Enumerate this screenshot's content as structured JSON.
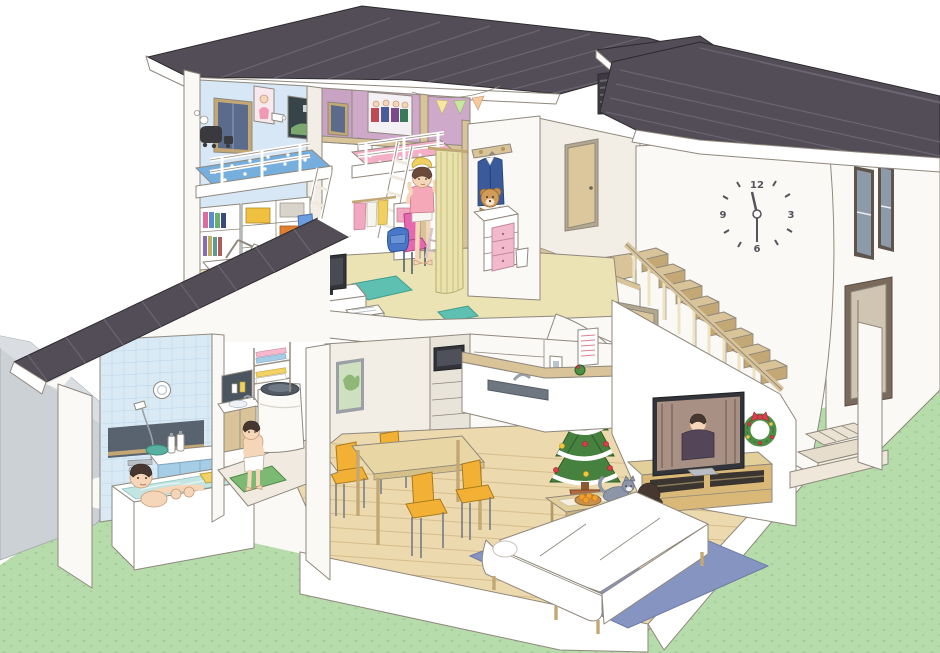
{
  "meta": {
    "title": "Cutaway cross-section illustration of a two-story family house",
    "description": "Isometric dollhouse-style cutaway showing a children's bedroom with two loft beds upstairs, a staircase with wall clock, and downstairs a bathroom with father bathing, a changing room with boy drying off, kitchen, dining set, and living room where a mother sits with two cats by a Christmas tree and TV.",
    "style": "isometric architectural cutaway illustration",
    "season": "Christmas"
  },
  "palette": {
    "roof": "#524d56",
    "roofSeam": "#6a6570",
    "line": "#8f887d",
    "line2": "#2e2b30",
    "wallWhite": "#faf9f6",
    "wallCream": "#f2eee6",
    "wood": "#d9c49a",
    "woodDark": "#c3a775",
    "woodFloor": "#ecd9ae",
    "plank": "#d6bd8c",
    "carpet": "#ece3b4",
    "tileBlue": "#d9eaf5",
    "tileLine": "#bcd7ea",
    "water": "#c2e4e2",
    "lawn": "#b7dcab",
    "lawnDot": "#a3cc95",
    "groundGray": "#ccd1d6",
    "rugBlue": "#8694c2",
    "rugTeal": "#5ec0b0",
    "bedBlue": "#76aede",
    "bedPink": "#f4aec6",
    "chairYellow": "#f2b135",
    "chairPink": "#e668b0",
    "chairBlue": "#6a9ce0",
    "skin": "#f6d6b8",
    "hairDark": "#463831",
    "hairBrown": "#6b4a3c",
    "tvDark": "#33343a",
    "doorTan": "#dcc79c",
    "curtain": "#e9e3ab",
    "treeGreen": "#47813f",
    "xmasRed": "#d6404e",
    "wallBlue": "#d7e7f5",
    "wallMauve": "#c9a3c4"
  },
  "clock": {
    "numerals": {
      "twelve": "12",
      "three": "3",
      "six": "6",
      "nine": "9"
    },
    "time_shown": "12:30"
  },
  "scene": {
    "floors": [
      "second floor: kids bedroom, closet, landing",
      "first floor: bathroom, changing room, kitchen, dining, living room, entry"
    ],
    "rooms": [
      {
        "name": "kids-bedroom",
        "objects": [
          "blue star loft bed",
          "pink heart loft bed",
          "two white ladders",
          "bookshelf",
          "storage cubbies with colored boxes",
          "study desk with lamp",
          "blue chair",
          "pink chair",
          "computer monitor",
          "black backpack",
          "blue schoolbag",
          "idol posters",
          "toy train wall decal",
          "dark window",
          "wall lamps",
          "pennant banner",
          "beige curtain",
          "school uniform on hanger",
          "teddy bear",
          "white dresser",
          "pink drawer chest",
          "teal rug"
        ]
      },
      {
        "name": "stair-hall",
        "objects": [
          "wall clock",
          "wooden staircase with railing",
          "tan doors",
          "wall niche",
          "louver vent"
        ]
      },
      {
        "name": "bathroom",
        "objects": [
          "bathtub with water",
          "shower head",
          "mixer faucet",
          "shampoo bottles",
          "green wash basin",
          "round vent fan",
          "blue tile wall",
          "yellow towel"
        ]
      },
      {
        "name": "changing-room",
        "objects": [
          "washing machine",
          "vanity sink",
          "towel shelf",
          "green bath mat",
          "white towel"
        ]
      },
      {
        "name": "kitchen",
        "objects": [
          "island counter with sink",
          "wood bar top",
          "built-in microwave",
          "cabinet drawers",
          "intercom panel",
          "wall calendar"
        ]
      },
      {
        "name": "dining",
        "objects": [
          "light wood dining table",
          "four yellow chairs",
          "green botanical picture"
        ]
      },
      {
        "name": "living-room",
        "objects": [
          "flat screen TV showing a person",
          "wooden TV stand",
          "Christmas wreath with red bow",
          "Christmas tree with star and garland",
          "coffee table",
          "basket of mandarin oranges",
          "blue rug",
          "white L-shaped sofa",
          "white cushion"
        ]
      },
      {
        "name": "entry",
        "objects": [
          "genkan tiled step",
          "porch post",
          "front door",
          "two tall windows"
        ]
      }
    ],
    "people": [
      {
        "name": "father",
        "activity": "relaxing in the bathtub",
        "location": "bathroom"
      },
      {
        "name": "boy",
        "activity": "drying off with a towel on the green mat",
        "location": "changing-room"
      },
      {
        "name": "girl",
        "activity": "drying hair with a yellow towel",
        "location": "kids-bedroom"
      },
      {
        "name": "mother",
        "activity": "sitting on the sofa petting a cat",
        "location": "living-room"
      },
      {
        "name": "tv-person",
        "activity": "speaking on the television screen",
        "location": "living-room"
      }
    ],
    "pets": [
      {
        "name": "gray-cat",
        "location": "on the coffee table"
      },
      {
        "name": "orange-cat",
        "location": "in a basket beside the mother"
      }
    ],
    "exterior": [
      "dark gray panel roofs",
      "clerestory louver vent",
      "green lawn",
      "gray retaining ground at left",
      "white walls"
    ]
  }
}
